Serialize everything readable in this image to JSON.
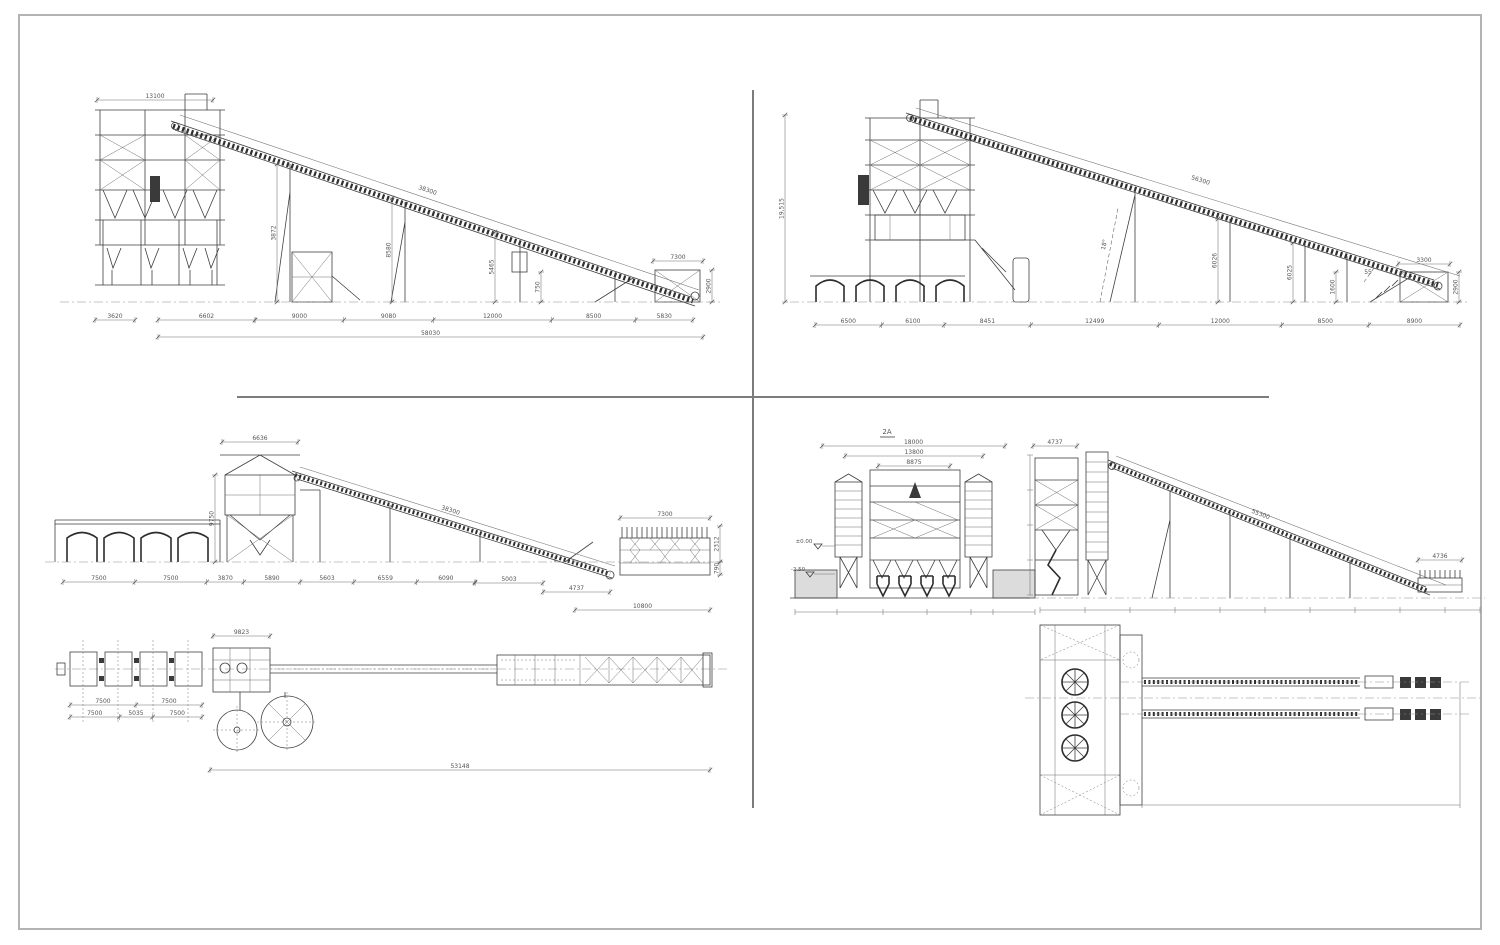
{
  "page": {
    "background": "#ffffff",
    "frame_color": "#b3b3b3",
    "divider_color": "#7c7c7c",
    "line_color": "#3f3f3f",
    "dim_color": "#5a5a5a"
  },
  "views": {
    "top_left_elevation": {
      "tower_width": "13100",
      "conveyor_length": "38300",
      "height_dims": [
        "3872",
        "8580",
        "5465",
        "750"
      ],
      "tail_top": "7300",
      "tail_height": "2900",
      "left_dim": "3620",
      "offset_dim": "6602",
      "bottom_dims": [
        "9000",
        "9080",
        "12000",
        "8500",
        "5830"
      ],
      "total_length": "58030"
    },
    "top_right_elevation": {
      "overall_height": "19,515",
      "conveyor_length": "56300",
      "incline_angle": "18°",
      "support_height_1": "6026",
      "support_height_2": "6025",
      "tail_support_height": "1600",
      "angle_note": "55",
      "head_top": "3300",
      "head_height": "2900",
      "bottom_dims": [
        "6500",
        "6100",
        "8451",
        "12499",
        "12000",
        "8500",
        "8900"
      ]
    },
    "bottom_left": {
      "elevation": {
        "tower_width": "6636",
        "tower_height": "9750",
        "conveyor_length": "38300",
        "bottom_dims": [
          "7500",
          "7500",
          "3870",
          "5890",
          "5603",
          "6559",
          "6090"
        ],
        "tail_dim_1": "5003",
        "tail_dim_2": "4737",
        "screen_top": "7300",
        "screen_height_1": "2312",
        "screen_height_2": "790",
        "screen_total": "10800"
      },
      "plan": {
        "building_width": "9823",
        "bin_dims_row1": [
          "7500",
          "7500"
        ],
        "bin_dims_row2": [
          "7500",
          "5035",
          "7500"
        ],
        "total_length": "53148"
      }
    },
    "bottom_right": {
      "front_elevation": {
        "view_label": "2A",
        "width_overall": "18000",
        "width_mid": "13800",
        "width_inner": "8875",
        "level_ground": "±0.00",
        "level_pit": "-2.50"
      },
      "side_elevation": {
        "head_width": "4737",
        "conveyor_length": "55300",
        "tail_width": "4736"
      }
    }
  }
}
